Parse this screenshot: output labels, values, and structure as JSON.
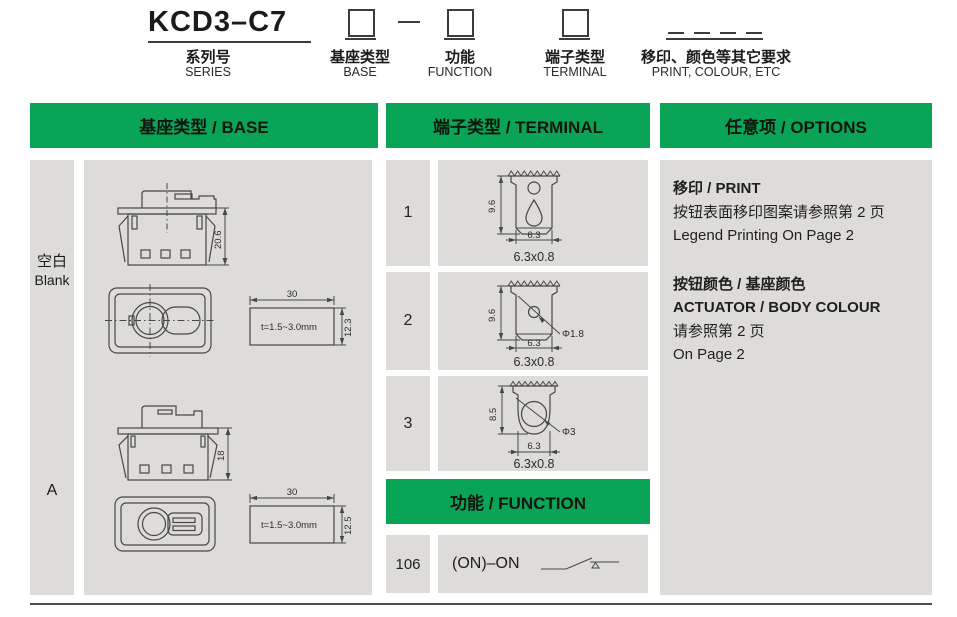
{
  "colors": {
    "green": "#0aa457",
    "panel": "#dedcd8",
    "line": "#474747"
  },
  "ordering": {
    "series_code": "KCD3–C7",
    "series_label_cn": "系列号",
    "series_label_en": "SERIES",
    "fields": [
      {
        "label_cn": "基座类型",
        "label_en": "BASE"
      },
      {
        "label_cn": "功能",
        "label_en": "FUNCTION"
      },
      {
        "label_cn": "端子类型",
        "label_en": "TERMINAL"
      },
      {
        "label_cn": "移印、颜色等其它要求",
        "label_en": "PRINT, COLOUR, ETC"
      }
    ]
  },
  "base_section": {
    "header": "基座类型 / BASE",
    "rows": [
      {
        "code_cn": "空白",
        "code_en": "Blank",
        "height_dim": "20.6",
        "cutout_width": "30",
        "cutout_height": "12.3",
        "panel_thickness": "t=1.5~3.0mm"
      },
      {
        "code": "A",
        "height_dim": "18",
        "cutout_width": "30",
        "cutout_height": "12.5",
        "panel_thickness": "t=1.5~3.0mm"
      }
    ]
  },
  "terminal_section": {
    "header": "端子类型 / TERMINAL",
    "rows": [
      {
        "code": "1",
        "height_dim": "9.6",
        "width_dim": "6.3",
        "caption": "6.3x0.8"
      },
      {
        "code": "2",
        "height_dim": "9.6",
        "width_dim": "6.3",
        "caption": "6.3x0.8",
        "hole_dim": "Φ1.8"
      },
      {
        "code": "3",
        "height_dim": "8.5",
        "width_dim": "6.3",
        "caption": "6.3x0.8",
        "hole_dim": "Φ3"
      }
    ]
  },
  "function_section": {
    "header": "功能 / FUNCTION",
    "rows": [
      {
        "code": "106",
        "label": "(ON)–ON"
      }
    ]
  },
  "options_section": {
    "header": "任意项 / OPTIONS",
    "print_title": "移印 / PRINT",
    "print_line_cn": "按钮表面移印图案请参照第 2 页",
    "print_line_en": "Legend Printing On Page 2",
    "colour_title": "按钮颜色 / 基座颜色",
    "colour_line1": "ACTUATOR / BODY COLOUR",
    "colour_line2": "请参照第 2 页",
    "colour_line3": "On Page 2"
  }
}
